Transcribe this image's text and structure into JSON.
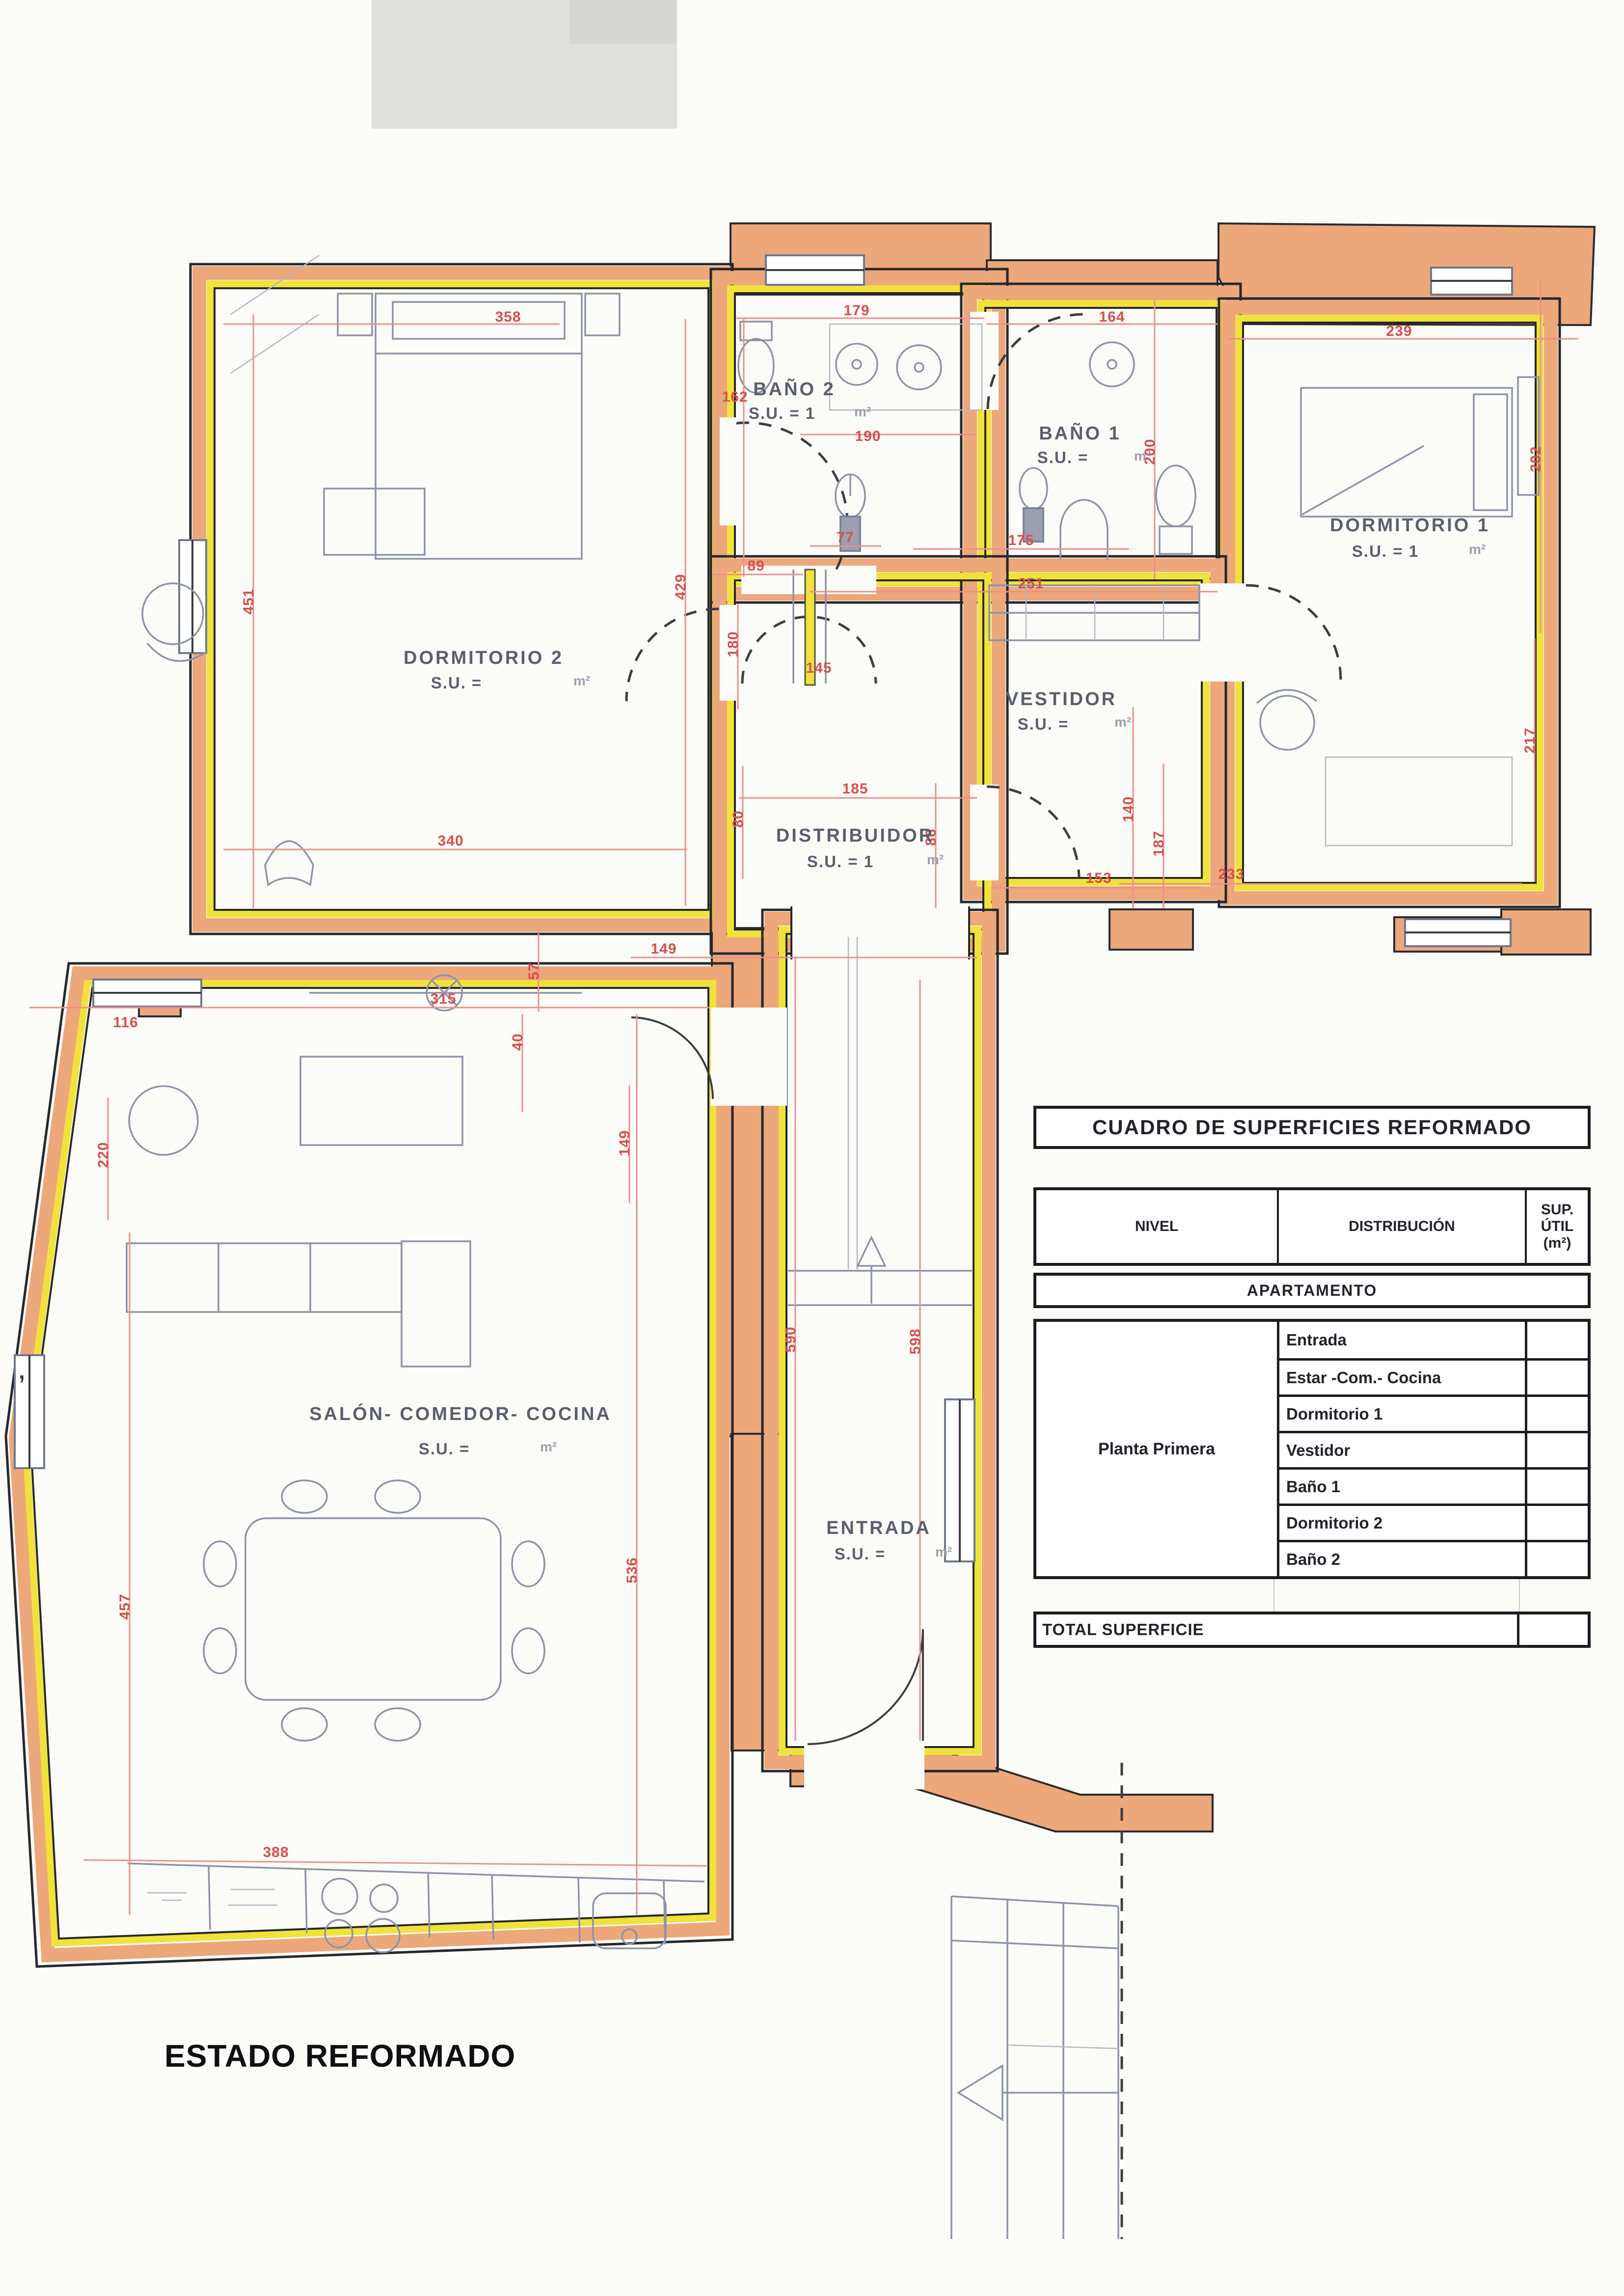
{
  "plan": {
    "drawing_title": "ESTADO REFORMADO",
    "rooms": [
      {
        "name": "DORMITORIO 2",
        "su": "S.U. =",
        "unit": "m²"
      },
      {
        "name": "BAÑO 2",
        "su": "S.U. = 1",
        "unit": "m²"
      },
      {
        "name": "BAÑO 1",
        "su": "S.U. =",
        "unit": "m²"
      },
      {
        "name": "DORMITORIO 1",
        "su": "S.U. = 1",
        "unit": "m²"
      },
      {
        "name": "VESTIDOR",
        "su": "S.U. =",
        "unit": "m²"
      },
      {
        "name": "DISTRIBUIDOR",
        "su": "S.U. = 1",
        "unit": "m²"
      },
      {
        "name": "SALÓN- COMEDOR- COCINA",
        "su": "S.U. =",
        "unit": "m²"
      },
      {
        "name": "ENTRADA",
        "su": "S.U. =",
        "unit": "m²"
      }
    ],
    "dims": [
      "358",
      "179",
      "164",
      "239",
      "162",
      "190",
      "200",
      "202",
      "451",
      "429",
      "89",
      "77",
      "175",
      "251",
      "180",
      "145",
      "185",
      "80",
      "86",
      "140",
      "187",
      "153",
      "233",
      "217",
      "340",
      "57",
      "315",
      "116",
      "40",
      "149",
      "149",
      "220",
      "590",
      "598",
      "536",
      "457",
      "388"
    ]
  },
  "table": {
    "title": "CUADRO DE SUPERFICIES REFORMADO",
    "columns": [
      "NIVEL",
      "DISTRIBUCIÓN",
      "SUP. ÚTIL (m²)"
    ],
    "section": "APARTAMENTO",
    "nivel": "Planta Primera",
    "rows": [
      {
        "label": "Entrada",
        "value": ""
      },
      {
        "label": "Estar -Com.- Cocina",
        "value": ""
      },
      {
        "label": "Dormitorio 1",
        "value": ""
      },
      {
        "label": "Vestidor",
        "value": ""
      },
      {
        "label": "Baño 1",
        "value": ""
      },
      {
        "label": "Dormitorio 2",
        "value": ""
      },
      {
        "label": "Baño 2",
        "value": ""
      }
    ],
    "total_label": "TOTAL SUPERFICIE",
    "total_value": ""
  },
  "colors": {
    "wall_orange": "#eca77b",
    "wall_yellow": "#f0e23a",
    "dimension_red": "#d6504e",
    "furniture_gray": "#8d93a6",
    "paper": "#fbfbf8"
  },
  "scan": {
    "stray_mark": ","
  }
}
